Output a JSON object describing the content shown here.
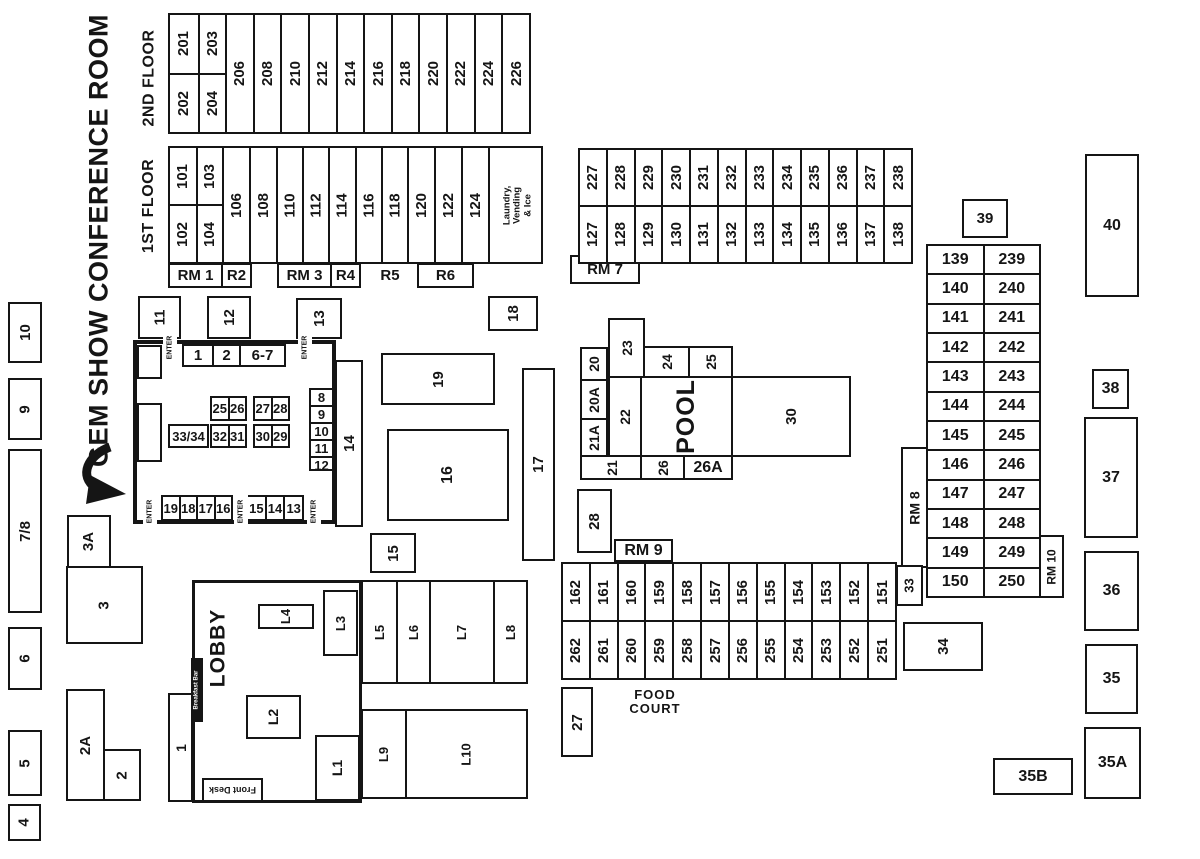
{
  "title": "GEM SHOW CONFERENCE ROOM",
  "labels": {
    "floor2": "2ND FLOOR",
    "floor1": "1ST FLOOR",
    "enter": "ENTER",
    "lobby": "LOBBY",
    "front_desk": "Front Desk",
    "breakfast_bar": "Breakfast Bar",
    "laundry": "Laundry,\nVending\n& Ice",
    "pool": "POOL",
    "food_court": "FOOD\nCOURT",
    "rm1": "RM 1",
    "r2": "R2",
    "rm3": "RM 3",
    "r4": "R4",
    "r5": "R5",
    "r6": "R6",
    "rm7": "RM 7",
    "rm8": "RM 8",
    "rm9": "RM 9",
    "rm10": "RM 10"
  },
  "floor2": {
    "upper": [
      "201",
      "203"
    ],
    "lower": [
      "202",
      "204"
    ],
    "rooms": [
      "206",
      "208",
      "210",
      "212",
      "214",
      "216",
      "218",
      "220",
      "222",
      "224",
      "226"
    ]
  },
  "floor1": {
    "upper": [
      "101",
      "103"
    ],
    "lower": [
      "102",
      "104"
    ],
    "rooms": [
      "106",
      "108",
      "110",
      "112",
      "114",
      "116",
      "118",
      "120",
      "122",
      "124"
    ]
  },
  "north_block": {
    "upper": [
      "227",
      "228",
      "229",
      "230",
      "231",
      "232",
      "233",
      "234",
      "235",
      "236",
      "237",
      "238"
    ],
    "lower": [
      "127",
      "128",
      "129",
      "130",
      "131",
      "132",
      "133",
      "134",
      "135",
      "136",
      "137",
      "138"
    ]
  },
  "east_block": {
    "first_floor": [
      "139",
      "140",
      "141",
      "142",
      "143",
      "144",
      "145",
      "146",
      "147",
      "148",
      "149",
      "150"
    ],
    "second_floor": [
      "239",
      "240",
      "241",
      "242",
      "243",
      "244",
      "245",
      "246",
      "247",
      "248",
      "249",
      "250"
    ]
  },
  "food_block": {
    "upper": [
      "162",
      "161",
      "160",
      "159",
      "158",
      "157",
      "156",
      "155",
      "154",
      "153",
      "152",
      "151"
    ],
    "lower": [
      "262",
      "261",
      "260",
      "259",
      "258",
      "257",
      "256",
      "255",
      "254",
      "253",
      "252",
      "251"
    ]
  },
  "conference": {
    "top_tables": [
      "1",
      "2",
      "6-7"
    ],
    "table_2526": [
      "25",
      "26"
    ],
    "table_2728": [
      "27",
      "28"
    ],
    "table_3334": "33/34",
    "table_3231": [
      "32",
      "31"
    ],
    "table_3029": [
      "30",
      "29"
    ],
    "side_stack": [
      "8",
      "9",
      "10",
      "11",
      "12"
    ],
    "bottom_tables_left": [
      "19",
      "18",
      "17",
      "16"
    ],
    "bottom_tables_right": [
      "15",
      "14",
      "13"
    ]
  },
  "pool_area": {
    "r20": "20",
    "r20a": "20A",
    "r21a": "21A",
    "r21": "21",
    "r22": "22",
    "r23": "23",
    "r24": "24",
    "r25": "25",
    "r26": "26",
    "r26a": "26A",
    "r30": "30"
  },
  "standalone": {
    "r4": "4",
    "r5": "5",
    "r6": "6",
    "r78": "7/8",
    "r9": "9",
    "r10": "10",
    "r1": "1",
    "r2": "2",
    "r2a": "2A",
    "r3": "3",
    "r3a": "3A",
    "r11": "11",
    "r12": "12",
    "r13": "13",
    "r14": "14",
    "r15": "15",
    "r16": "16",
    "r17": "17",
    "r18": "18",
    "r19": "19",
    "r27": "27",
    "r28": "28",
    "r33": "33",
    "r34": "34",
    "r35": "35",
    "r35a": "35A",
    "r35b": "35B",
    "r36": "36",
    "r37": "37",
    "r38": "38",
    "r39": "39",
    "r40": "40"
  },
  "lobby_units": {
    "l1": "L1",
    "l2": "L2",
    "l3": "L3",
    "l4": "L4",
    "l5": "L5",
    "l6": "L6",
    "l7": "L7",
    "l8": "L8",
    "l9": "L9",
    "l10": "L10"
  }
}
